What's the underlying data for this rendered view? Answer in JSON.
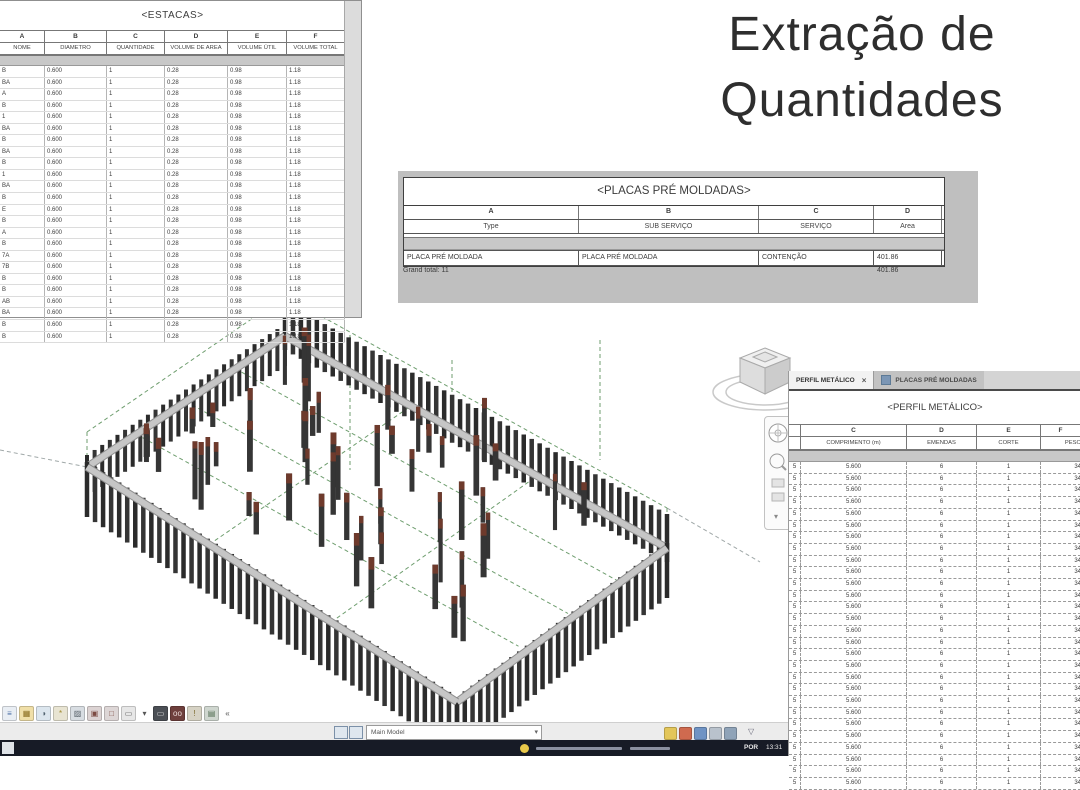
{
  "page_title": "Extração de Quantidades",
  "estacas": {
    "title": "<ESTACAS>",
    "letters": [
      "A",
      "B",
      "C",
      "D",
      "E",
      "F"
    ],
    "headers": [
      "NOME",
      "DIAMETRO",
      "QUANTIDADE",
      "VOLUME DE AREA",
      "VOLUME ÚTIL",
      "VOLUME TOTAL"
    ],
    "name_fragments": [
      "B",
      "BA",
      "A",
      "B",
      "1",
      "BA",
      "B",
      "BA",
      "B",
      "1",
      "BA",
      "B",
      "E",
      "B",
      "A",
      "B",
      "7A",
      "7B",
      "B",
      "B",
      "AB",
      "BA",
      "B",
      "B"
    ],
    "row_values": [
      "0.600",
      "1",
      "0.28",
      "0.98",
      "1.18"
    ]
  },
  "placas": {
    "title": "<PLACAS PRÉ MOLDADAS>",
    "letters": [
      "A",
      "B",
      "C",
      "D"
    ],
    "headers": [
      "Type",
      "SUB SERVIÇO",
      "SERVIÇO",
      "Area"
    ],
    "rows": [
      [
        "PLACA PRÉ MOLDADA",
        "PLACA PRÉ MOLDADA",
        "CONTENÇÃO",
        "401.86"
      ]
    ],
    "grand_total_label": "Grand total: 11",
    "grand_total_value": "401.86"
  },
  "perfil": {
    "tabs": {
      "active": "PERFIL METÁLICO",
      "close_glyph": "×",
      "inactive": "PLACAS PRÉ MOLDADAS"
    },
    "title": "<PERFIL METÁLICO>",
    "letters": [
      "",
      "C",
      "D",
      "E",
      "F"
    ],
    "headers": [
      "",
      "COMPRIMENTO (m)",
      "EMENDAS",
      "CORTE",
      "PESO"
    ],
    "row_template": [
      "5",
      "5.600",
      "6",
      "1",
      "34"
    ],
    "row_count": 28
  },
  "view_control_bar": {
    "icons": [
      {
        "name": "scale-icon",
        "glyph": "≡",
        "bg": "#e9eef4",
        "fg": "#4a6fa5"
      },
      {
        "name": "detail-level-icon",
        "glyph": "▦",
        "bg": "#f0dfa8",
        "fg": "#8a6d1f"
      },
      {
        "name": "visual-style-icon",
        "glyph": "◑",
        "bg": "#dce6ee",
        "fg": "#51626f"
      },
      {
        "name": "sun-path-icon",
        "glyph": "*",
        "bg": "#e8e4d2",
        "fg": "#a08a30"
      },
      {
        "name": "shadows-icon",
        "glyph": "▨",
        "bg": "#d8dde2",
        "fg": "#5a636b"
      },
      {
        "name": "rendering-dialog-icon",
        "glyph": "▣",
        "bg": "#dcd3d3",
        "fg": "#7c4a42"
      },
      {
        "name": "crop-view-icon",
        "glyph": "□",
        "bg": "#ddd6d6",
        "fg": "#7c4a42"
      },
      {
        "name": "show-crop-region-icon",
        "glyph": "▭",
        "bg": "#e7e7e7",
        "fg": "#666666"
      },
      {
        "name": "view-dropdown-arrow-icon",
        "glyph": "▾",
        "bg": "transparent",
        "fg": "#555555"
      },
      {
        "name": "selection-frame-icon",
        "glyph": "▭",
        "bg": "#4b4f55",
        "fg": "#d9d9d9"
      },
      {
        "name": "temporary-hide-isolate-icon",
        "glyph": "oo",
        "bg": "#6e3f3c",
        "fg": "#e8d7d5"
      },
      {
        "name": "reveal-hidden-elements-icon",
        "glyph": "!",
        "bg": "#d6d2c4",
        "fg": "#7c6b2f"
      },
      {
        "name": "temporary-view-properties-icon",
        "glyph": "▤",
        "bg": "#cfd6cf",
        "fg": "#4f6b4f"
      },
      {
        "name": "collapse-bar-icon",
        "glyph": "«",
        "bg": "transparent",
        "fg": "#555555"
      }
    ]
  },
  "status_bar": {
    "main_model": "Main Model",
    "left_icons": [
      "tile-windows-icon",
      "cascade-windows-icon"
    ],
    "right_icons": [
      "worksets-icon",
      "design-options-icon",
      "link-monitor-icon",
      "exclusions-icon",
      "press-drag-icon"
    ],
    "filter_glyph": "▽"
  },
  "taskbar": {
    "language": "POR",
    "time": "13:31"
  },
  "colors": {
    "pile_dark": "#353535",
    "pile_cap_red": "#6e3a2c",
    "beam_gray": "#c6c6c6",
    "grid_green": "#6f9e6f",
    "backdrop_gray": "#bfbfbf",
    "taskbar_bg": "#171b26"
  }
}
